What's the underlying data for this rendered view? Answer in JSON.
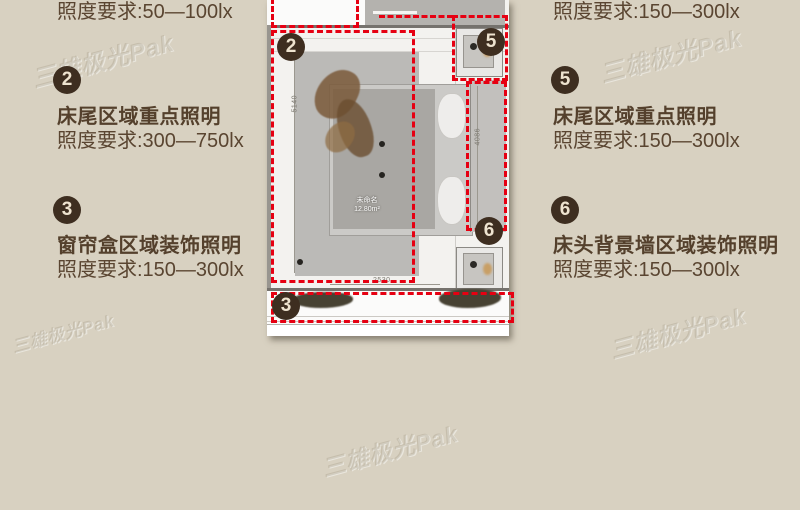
{
  "colors": {
    "background": "#d8d1c1",
    "accent_red": "#e60012",
    "badge": "#3e2e20",
    "text": "#5a4531"
  },
  "watermark": {
    "text": "三雄极光Pak"
  },
  "left_column": {
    "items": [
      {
        "requirement": "照度要求:50—100lx"
      },
      {
        "number": "2",
        "title": "床尾区域重点照明",
        "requirement": "照度要求:300—750lx"
      },
      {
        "number": "3",
        "title": "窗帘盒区域装饰照明",
        "requirement": "照度要求:150—300lx"
      }
    ]
  },
  "right_column": {
    "items": [
      {
        "requirement": "照度要求:150—300lx"
      },
      {
        "number": "5",
        "title": "床尾区域重点照明",
        "requirement": "照度要求:150—300lx"
      },
      {
        "number": "6",
        "title": "床头背景墙区域装饰照明",
        "requirement": "照度要求:150—300lx"
      }
    ]
  },
  "floorplan": {
    "room_name": "未命名",
    "room_area": "12.80m²",
    "dim_left": "5140",
    "dim_right": "4086",
    "dim_bottom": "2530",
    "badges": [
      {
        "label": "2"
      },
      {
        "label": "5"
      },
      {
        "label": "6"
      },
      {
        "label": "3"
      }
    ]
  }
}
